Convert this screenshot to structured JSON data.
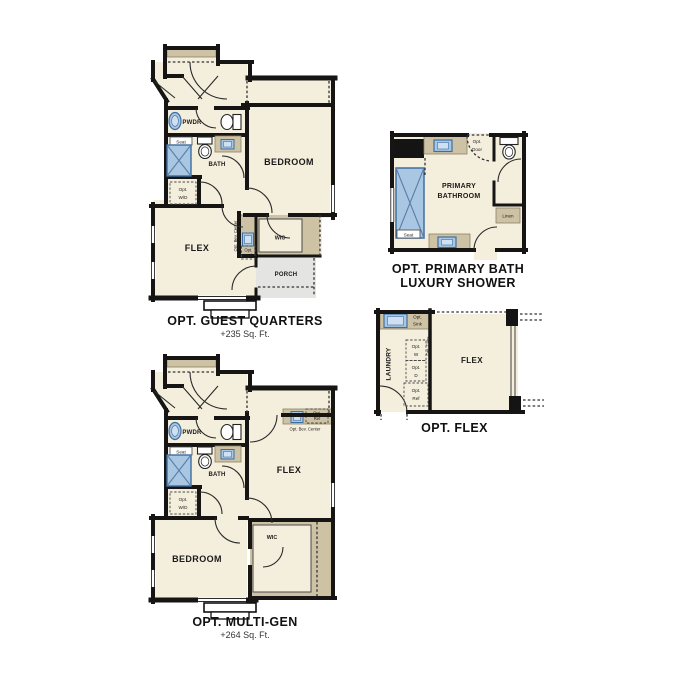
{
  "document": {
    "type": "floor-plan-options-sheet",
    "background": "#ffffff"
  },
  "colors": {
    "floor": "#f4eedc",
    "wall": "#161514",
    "counter_tan": "#cec2a5",
    "fixture_blue": "#a9c7e3",
    "fixture_blue_border": "#3f6ea0",
    "porch_gray": "#e4e4e2",
    "text": "#1a1a1a"
  },
  "plans": {
    "guest_quarters": {
      "title": "OPT. GUEST QUARTERS",
      "subtitle": "+235 Sq. Ft.",
      "labels": {
        "bedroom": "BEDROOM",
        "flex": "FLEX",
        "pwdr": "PWDR",
        "bath": "BATH",
        "seat": "Seat",
        "wic": "WIC",
        "porch": "PORCH",
        "opt_wd_line1": "Opt.",
        "opt_wd_line2": "W/D",
        "opt_bev_center": "Opt. Bev. Center",
        "opt_ref_line1": "Opt.",
        "opt_ref_line2": "Ref"
      }
    },
    "primary_bath": {
      "title_line1": "OPT. PRIMARY BATH",
      "title_line2": "LUXURY SHOWER",
      "labels": {
        "primary_line1": "PRIMARY",
        "primary_line2": "BATHROOM",
        "seat": "Seat",
        "linen": "Linen",
        "opt_door_line1": "Opt.",
        "opt_door_line2": "Door"
      }
    },
    "flex_opt": {
      "title": "OPT. FLEX",
      "labels": {
        "laundry": "LAUNDRY",
        "flex": "FLEX",
        "opt_sink_line1": "Opt.",
        "opt_sink_line2": "Sink",
        "opt_cabs": "Opt. Cabs",
        "opt_w_line1": "Opt.",
        "opt_w_line2": "W",
        "opt_d_line1": "Opt.",
        "opt_d_line2": "D",
        "opt_ref_line1": "Opt.",
        "opt_ref_line2": "Ref"
      }
    },
    "multi_gen": {
      "title": "OPT. MULTI-GEN",
      "subtitle": "+264 Sq. Ft.",
      "labels": {
        "bedroom": "BEDROOM",
        "flex": "FLEX",
        "pwdr": "PWDR",
        "bath": "BATH",
        "seat": "Seat",
        "wic": "WIC",
        "opt_wd_line1": "Opt.",
        "opt_wd_line2": "W/D",
        "opt_bev_center": "Opt. Bev. Center",
        "opt_ref_line1": "Opt.",
        "opt_ref_line2": "Ref"
      }
    }
  }
}
